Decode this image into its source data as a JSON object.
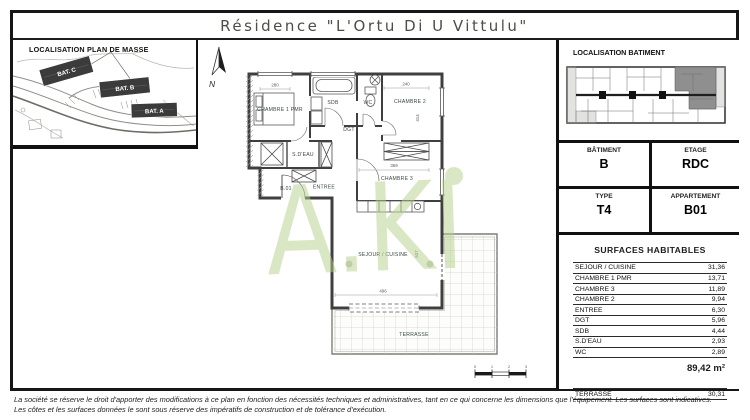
{
  "title": "Résidence \"L'Ortu Di U Vittulu\"",
  "site_panel": {
    "title": "LOCALISATION PLAN DE MASSE",
    "buildings": [
      {
        "label": "BAT. C"
      },
      {
        "label": "BAT. B"
      },
      {
        "label": "BAT. A"
      }
    ]
  },
  "plan": {
    "north_label": "N",
    "watermark": "A.KI",
    "rooms": [
      {
        "label": "CHAMBRE 1 PMR"
      },
      {
        "label": "SDB"
      },
      {
        "label": "WC"
      },
      {
        "label": "CHAMBRE 2"
      },
      {
        "label": "DGT"
      },
      {
        "label": "CHAMBRE 3"
      },
      {
        "label": "S.D'EAU"
      },
      {
        "label": "ENTREE"
      },
      {
        "label": "B.01"
      },
      {
        "label": "SEJOUR / CUISINE"
      },
      {
        "label": "TERRASSE"
      }
    ],
    "dimensions": [
      {
        "value": "280"
      },
      {
        "value": "240"
      },
      {
        "value": "414"
      },
      {
        "value": "369"
      },
      {
        "value": "496"
      },
      {
        "value": "637"
      }
    ],
    "scale_ticks": [
      "0",
      "1",
      "2",
      "3"
    ]
  },
  "unit_panel": {
    "title": "LOCALISATION BATIMENT",
    "info": {
      "batiment_label": "BÂTIMENT",
      "batiment_value": "B",
      "etage_label": "ETAGE",
      "etage_value": "RDC",
      "type_label": "TYPE",
      "type_value": "T4",
      "appartement_label": "APPARTEMENT",
      "appartement_value": "B01"
    },
    "surfaces": {
      "title": "SURFACES HABITABLES",
      "rows": [
        {
          "label": "SEJOUR / CUISINE",
          "value": "31,36"
        },
        {
          "label": "CHAMBRE 1 PMR",
          "value": "13,71"
        },
        {
          "label": "CHAMBRE 3",
          "value": "11,89"
        },
        {
          "label": "CHAMBRE 2",
          "value": "9,94"
        },
        {
          "label": "ENTREE",
          "value": "6,30"
        },
        {
          "label": "DGT",
          "value": "5,96"
        },
        {
          "label": "SDB",
          "value": "4,44"
        },
        {
          "label": "S.D'EAU",
          "value": "2,93"
        },
        {
          "label": "WC",
          "value": "2,89"
        }
      ],
      "total": "89,42 m²",
      "terrace_row": {
        "label": "TERRASSE",
        "value": "30,31"
      }
    }
  },
  "footer": {
    "line1": "La société se réserve le droit d'apporter des modifications à ce plan en fonction des nécessités techniques et administratives, tant en ce qui concerne les dimensions que l'équipement. Les surfaces sont indicatives.",
    "line2": "Les côtes et les surfaces données le sont sous réserve des impératifs de construction et de tolérance d'exécution."
  },
  "colors": {
    "watermark_green": "#b7d18c",
    "wall": "#3f3f3f"
  }
}
